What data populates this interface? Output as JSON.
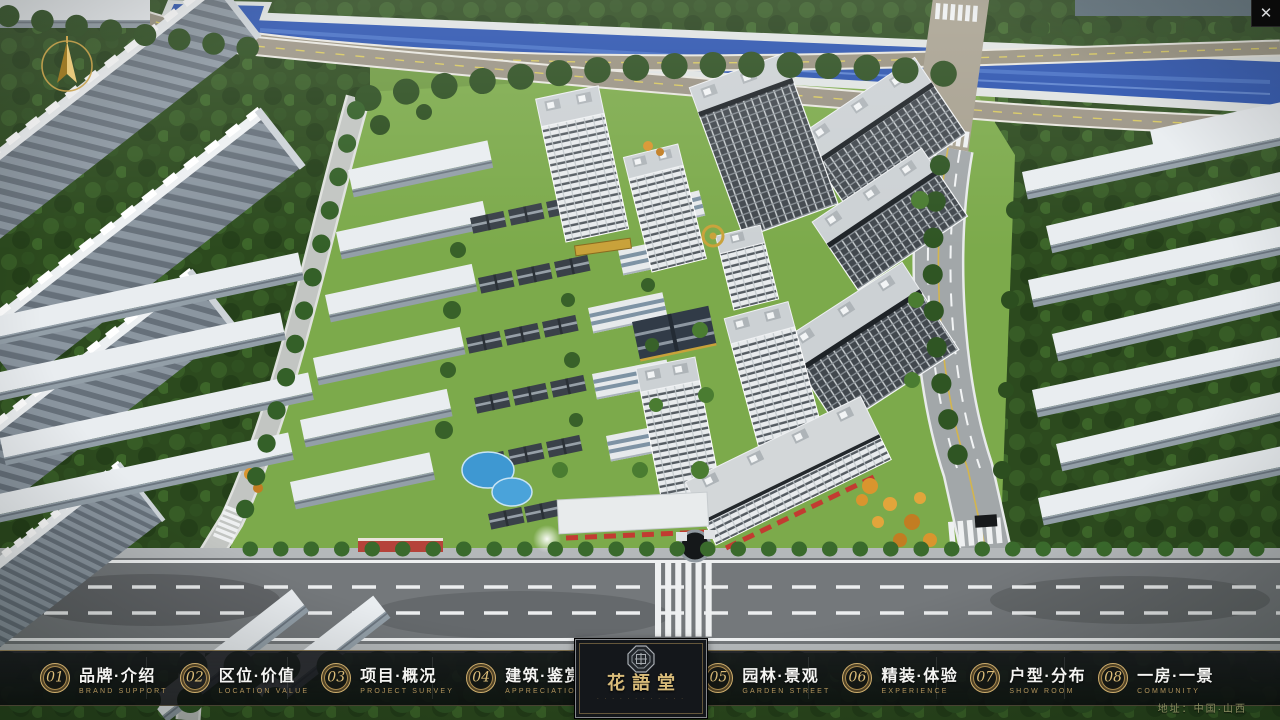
{
  "ui": {
    "close_icon": "✕",
    "address": "地址：中国·山西"
  },
  "logo": {
    "title": "花語堂",
    "subtitle": "· · · · · · · · · · · ·"
  },
  "menu": {
    "items": [
      {
        "num": "01",
        "zh": "品牌·介绍",
        "en": "BRAND SUPPORT"
      },
      {
        "num": "02",
        "zh": "区位·价值",
        "en": "LOCATION VALUE"
      },
      {
        "num": "03",
        "zh": "项目·概况",
        "en": "PROJECT SURVEY"
      },
      {
        "num": "04",
        "zh": "建筑·鉴赏",
        "en": "APPRECIATION"
      },
      {
        "num": "05",
        "zh": "园林·景观",
        "en": "GARDEN STREET"
      },
      {
        "num": "06",
        "zh": "精装·体验",
        "en": "EXPERIENCE"
      },
      {
        "num": "07",
        "zh": "户型·分布",
        "en": "SHOW ROOM"
      },
      {
        "num": "08",
        "zh": "一房·一景",
        "en": "COMMUNITY"
      }
    ]
  },
  "colors": {
    "gold_accent": "#c9a86a",
    "bar_background": "#0e1013",
    "canal_blue": "#2a52ae",
    "lawn_green": "#76a441"
  }
}
